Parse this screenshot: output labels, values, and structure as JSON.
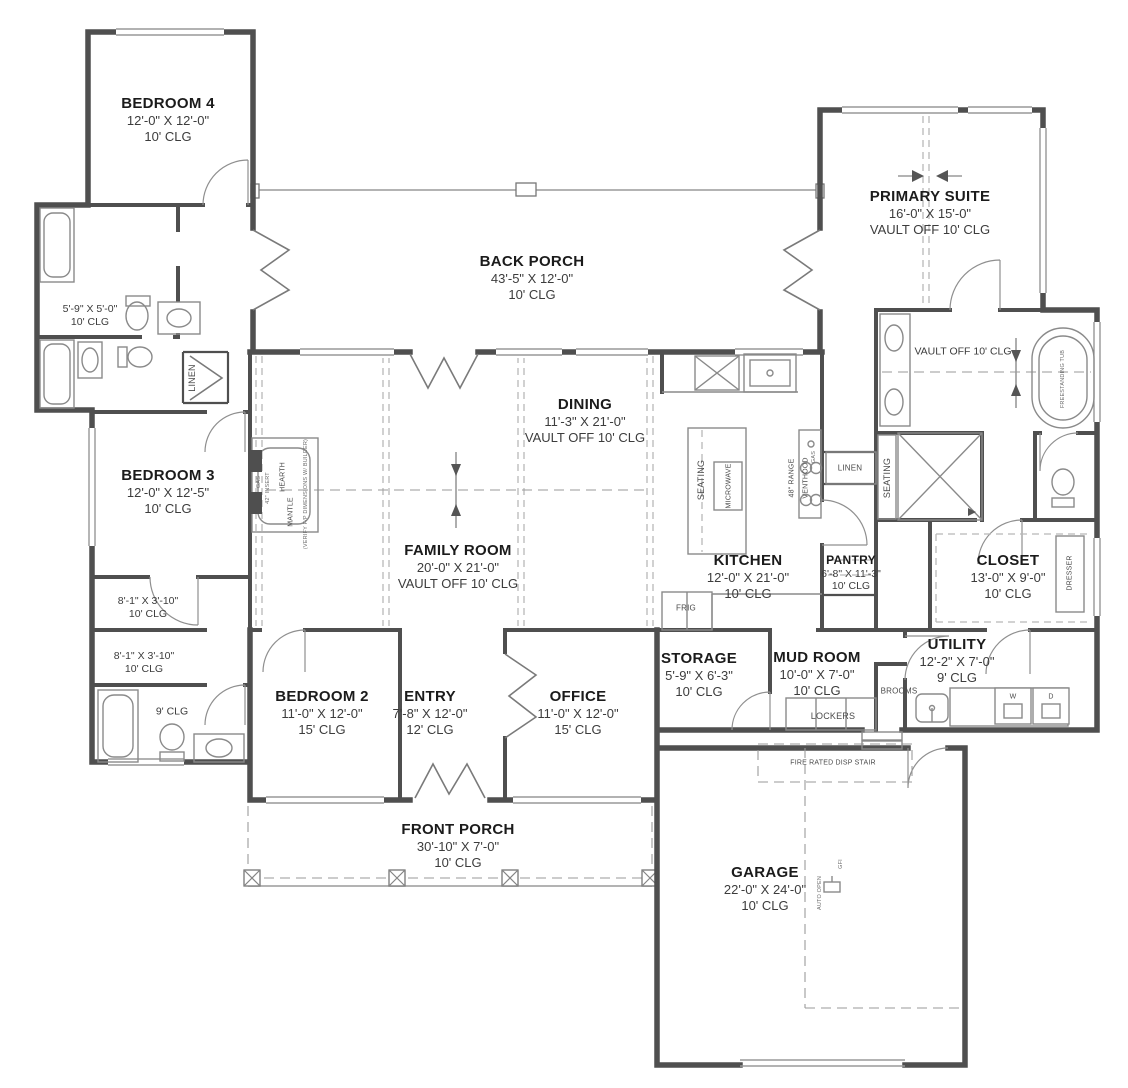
{
  "colors": {
    "wall": "#4f4f4f",
    "fixture": "#8a8a8a",
    "dash": "#b8b8b8",
    "ink": "#1b1b1b",
    "paper": "#ffffff"
  },
  "rooms": [
    {
      "name": "BEDROOM 4",
      "dims": "12'-0\" X 12'-0\"",
      "clg": "10' CLG"
    },
    {
      "name": "",
      "dims": "5'-9\" X 5'-0\"",
      "clg": "10' CLG"
    },
    {
      "name": "BEDROOM 3",
      "dims": "12'-0\" X 12'-5\"",
      "clg": "10' CLG"
    },
    {
      "name": "BACK PORCH",
      "dims": "43'-5\" X 12'-0\"",
      "clg": "10' CLG"
    },
    {
      "name": "PRIMARY SUITE",
      "dims": "16'-0\" X 15'-0\"",
      "clg": "VAULT OFF 10' CLG"
    },
    {
      "name": "",
      "dims": "",
      "clg": "VAULT OFF 10' CLG"
    },
    {
      "name": "DINING",
      "dims": "11'-3\" X 21'-0\"",
      "clg": "VAULT OFF 10' CLG"
    },
    {
      "name": "FAMILY ROOM",
      "dims": "20'-0\" X 21'-0\"",
      "clg": "VAULT OFF 10' CLG"
    },
    {
      "name": "KITCHEN",
      "dims": "12'-0\" X 21'-0\"",
      "clg": "10' CLG"
    },
    {
      "name": "PANTRY",
      "dims": "6'-8\" X 11'-3\"",
      "clg": "10' CLG"
    },
    {
      "name": "CLOSET",
      "dims": "13'-0\" X 9'-0\"",
      "clg": "10' CLG"
    },
    {
      "name": "",
      "dims": "8'-1\" X 3'-10\"",
      "clg": "10' CLG"
    },
    {
      "name": "",
      "dims": "8'-1\" X 3'-10\"",
      "clg": "10' CLG"
    },
    {
      "name": "",
      "dims": "",
      "clg": "9' CLG"
    },
    {
      "name": "BEDROOM 2",
      "dims": "11'-0\" X 12'-0\"",
      "clg": "15' CLG"
    },
    {
      "name": "ENTRY",
      "dims": "7'-8\" X 12'-0\"",
      "clg": "12' CLG"
    },
    {
      "name": "OFFICE",
      "dims": "11'-0\" X 12'-0\"",
      "clg": "15' CLG"
    },
    {
      "name": "STORAGE",
      "dims": "5'-9\" X 6'-3\"",
      "clg": "10' CLG"
    },
    {
      "name": "MUD ROOM",
      "dims": "10'-0\" X 7'-0\"",
      "clg": "10' CLG"
    },
    {
      "name": "UTILITY",
      "dims": "12'-2\" X 7'-0\"",
      "clg": "9' CLG"
    },
    {
      "name": "FRONT PORCH",
      "dims": "30'-10\" X 7'-0\"",
      "clg": "10' CLG"
    },
    {
      "name": "GARAGE",
      "dims": "22'-0\" X 24'-0\"",
      "clg": "10' CLG"
    }
  ],
  "labels": {
    "linen_left": "LINEN",
    "linen_pantry": "LINEN",
    "seating_island": "SEATING",
    "microwave": "MICROWAVE",
    "range": "48\" RANGE",
    "venthood": "VENTHOOD",
    "gas_range": "GAS",
    "gas_fp": "GAS",
    "insert_fp": "42\" INSERT",
    "hearth": "HEARTH",
    "mantle": "MANTLE",
    "verify_fp": "(VERIFY F/P DIMENSIONS W/ BUILDER)",
    "seating_primary": "SEATING",
    "dresser": "DRESSER",
    "frig": "FRIG",
    "brooms": "BROOMS",
    "lockers": "LOCKERS",
    "fire_stair": "FIRE RATED DISP STAIR",
    "washer": "W",
    "dryer": "D",
    "gfi": "GFI",
    "auto_open": "AUTO OPEN",
    "freestanding_tub": "FREESTANDING TUB"
  }
}
